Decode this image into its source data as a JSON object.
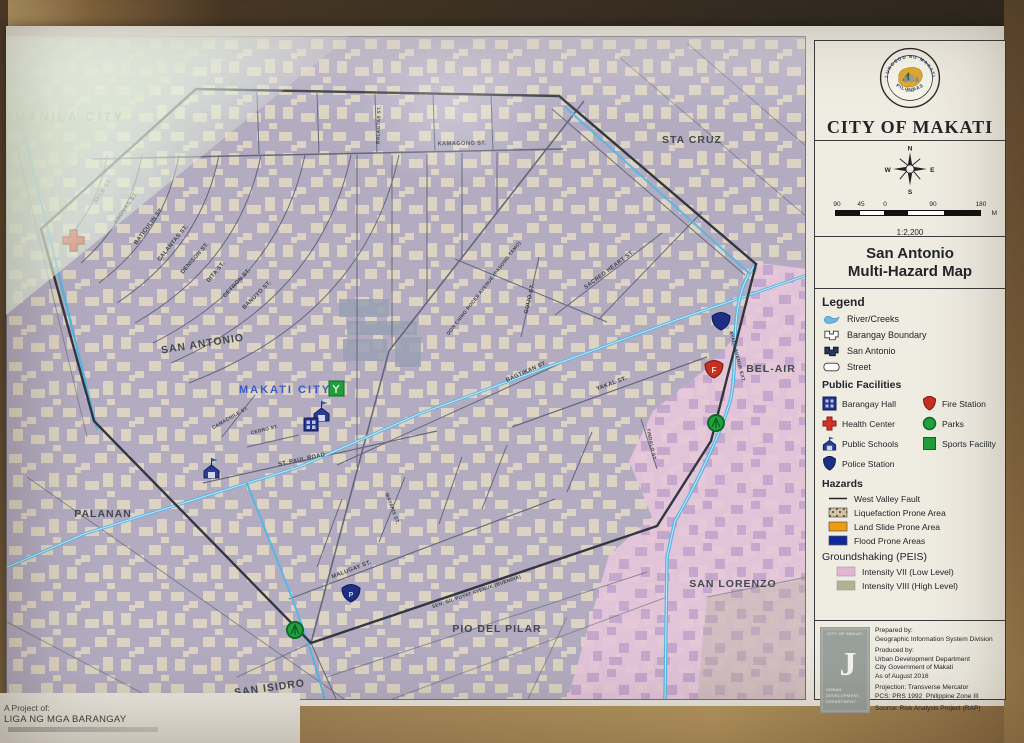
{
  "panel": {
    "seal": {
      "arc_top": "LUNGSOD NG MAKATI",
      "arc_bottom": "PILIPINAS",
      "year": "1990"
    },
    "city_title": "CITY OF MAKATI",
    "compass": {
      "n": "N",
      "e": "E",
      "s": "S",
      "w": "W"
    },
    "scale": {
      "t0": "90",
      "t1": "45",
      "t2": "0",
      "t3": "90",
      "t4": "180",
      "unit": "M",
      "ratio": "1:2,200"
    },
    "map_title1": "San Antonio",
    "map_title2": "Multi-Hazard Map",
    "legend": {
      "title": "Legend",
      "items": [
        {
          "label": "River/Creeks"
        },
        {
          "label": "Barangay Boundary"
        },
        {
          "label": "San Antonio"
        },
        {
          "label": "Street"
        }
      ],
      "facilities_title": "Public Facilities",
      "facilities": [
        {
          "label": "Barangay Hall"
        },
        {
          "label": "Fire Station"
        },
        {
          "label": "Health Center"
        },
        {
          "label": "Parks"
        },
        {
          "label": "Public Schools"
        },
        {
          "label": "Sports Facility"
        },
        {
          "label": "Police Station"
        }
      ],
      "hazards_title": "Hazards",
      "hazards": [
        {
          "label": "West Valley Fault"
        },
        {
          "label": "Liquefaction Prone Area"
        },
        {
          "label": "Land Slide Prone Area"
        },
        {
          "label": "Flood Prone Areas"
        }
      ],
      "shaking_title": "Groundshaking (PEIS)",
      "shaking": [
        {
          "label": "Intensity VII (Low Level)"
        },
        {
          "label": "Intensity VIII (High Level)"
        }
      ]
    },
    "credits": {
      "logo_top": "CITY OF MAKATI",
      "logo_letter": "J",
      "logo_b1": "URBAN",
      "logo_b2": "DEVELOPMENT",
      "logo_b3": "DEPARTMENT",
      "prepared_label": "Prepared by:",
      "prepared": "Geographic Information System Division",
      "produced_label": "Produced by:",
      "produced1": "Urban Development Department",
      "produced2": "City Government of Makati",
      "produced3": "As of August 2016",
      "projection": "Projection: Transverse Mercator",
      "pcs": "PCS: PRS 1992_Philippine Zone III",
      "source": "Source: Risk Analysis Project (RAP)"
    }
  },
  "map": {
    "city_label": "MAKATI CITY",
    "fire_glyph": "F",
    "police_glyph": "P",
    "districts": [
      {
        "text": "MANILA CITY"
      },
      {
        "text": "STA CRUZ"
      },
      {
        "text": "SAN ANTONIO"
      },
      {
        "text": "PALANAN"
      },
      {
        "text": "BEL-AIR"
      },
      {
        "text": "SAN LORENZO"
      },
      {
        "text": "PIO DEL PILAR"
      },
      {
        "text": "SAN ISIDRO"
      }
    ],
    "streets": [
      {
        "text": "KAMAGONG ST."
      },
      {
        "text": "BALAGTAS ST."
      },
      {
        "text": "AKLE ST."
      },
      {
        "text": "ANONAS ST."
      },
      {
        "text": "BATICULIN ST."
      },
      {
        "text": "CALANTAS ST."
      },
      {
        "text": "DENISON ST."
      },
      {
        "text": "DITA ST."
      },
      {
        "text": "CETRON ST."
      },
      {
        "text": "BANUYO ST."
      },
      {
        "text": "DON CHINO ROCES AVENUE (PASONG TAMO)"
      },
      {
        "text": "SACRED HEART ST."
      },
      {
        "text": "GUIJO ST."
      },
      {
        "text": "BAGTIKAN ST."
      },
      {
        "text": "YAKAL ST."
      },
      {
        "text": "TINDALO ST."
      },
      {
        "text": "ST. PAUL ROAD"
      },
      {
        "text": "CAMACHILE ST."
      },
      {
        "text": "CEDRO ST."
      },
      {
        "text": "MAYAPIS ST."
      },
      {
        "text": "MALUGAY ST."
      },
      {
        "text": "SEN. GIL PUYAT AVENUE (BUENDIA)"
      },
      {
        "text": "AYALA AVENUE EXT."
      }
    ]
  },
  "footer": {
    "project_label": "A Project of:",
    "project_name": "LIGA NG MGA BARANGAY"
  },
  "colors": {
    "intensity_vii": "#e0b6d4",
    "intensity_viii": "#b2b194",
    "flood": "#10269c",
    "landslide": "#f09a10",
    "navy": "#20317f",
    "red": "#c23526",
    "green": "#1f9e3c",
    "creek": "#5cb8e4",
    "pink_zone": "#e7c6dc"
  }
}
